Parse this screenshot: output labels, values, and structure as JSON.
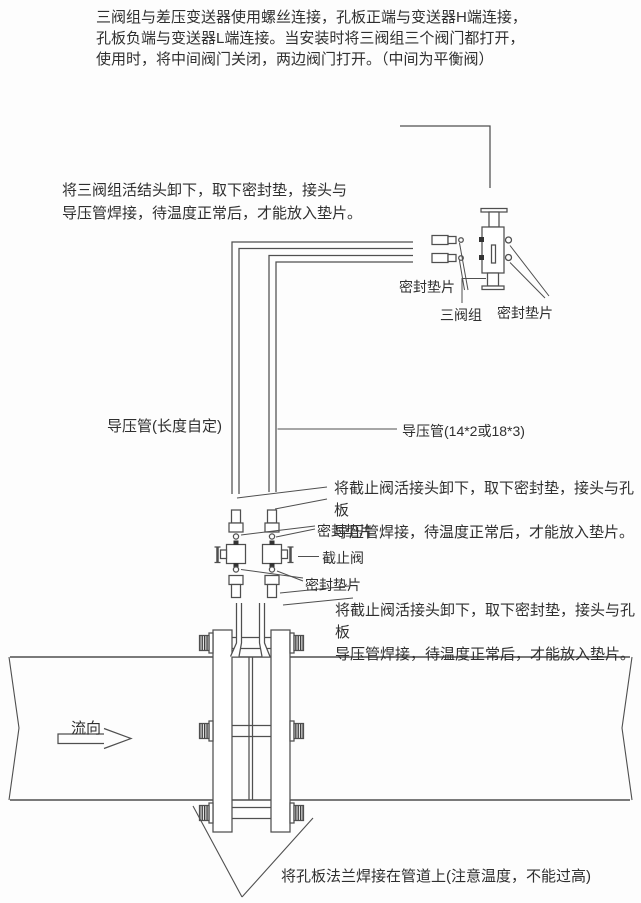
{
  "colors": {
    "line": "#4f4f4f",
    "text": "#2f2f2f",
    "background": "#fdfdfd"
  },
  "notes": {
    "top": "三阀组与差压变送器使用螺丝连接，孔板正端与变送器H端连接，\n孔板负端与变送器L端连接。当安装时将三阀组三个阀门都打开，\n使用时，将中间阀门关闭，两边阀门打开。（中间为平衡阀）",
    "manifold_union": "将三阀组活结头卸下，取下密封垫，接头与\n导压管焊接，待温度正常后，才能放入垫片。",
    "stop_valve_upper": "将截止阀活接头卸下，取下密封垫，接头与孔板\n导压管焊接，待温度正常后，才能放入垫片。",
    "stop_valve_lower": "将截止阀活接头卸下，取下密封垫，接头与孔板\n导压管焊接，待温度正常后，才能放入垫片。",
    "weld": "将孔板法兰焊接在管道上(注意温度，不能过高)"
  },
  "labels": {
    "seal_gasket_top_left": "密封垫片",
    "three_valve_manifold": "三阀组",
    "seal_gasket_top_right": "密封垫片",
    "impulse_pipe_custom": "导压管(长度自定)",
    "impulse_pipe_size": "导压管(14*2或18*3)",
    "seal_gasket_valve_upper": "密封垫片",
    "stop_valve": "截止阀",
    "seal_gasket_valve_lower": "密封垫片",
    "flow_direction": "流向"
  }
}
